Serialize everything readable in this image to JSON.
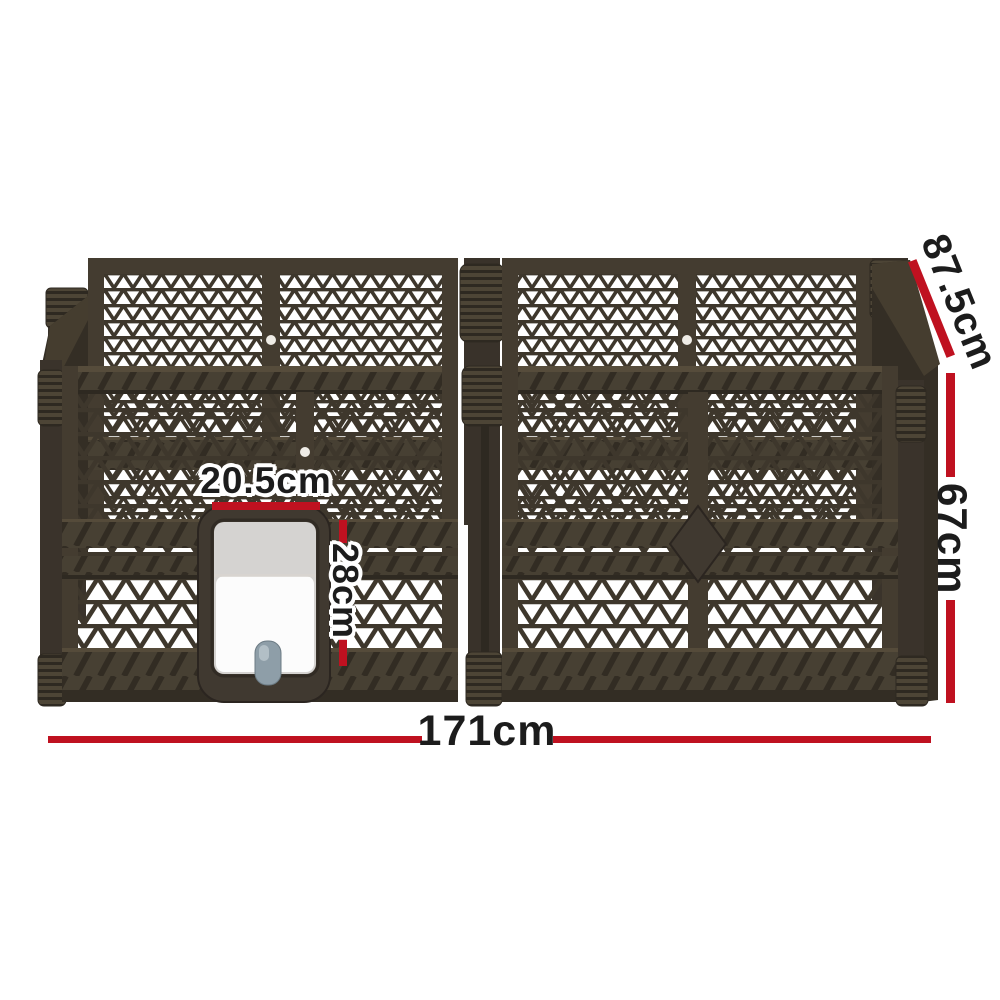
{
  "diagram": {
    "type": "product-dimensions",
    "subject": "foldable pet playpen with lockable pet door",
    "annotation_color": "#bf1120",
    "text_color": "#1c1c1c",
    "frame_color": "#443c30",
    "latch_color": "#8e9ea8"
  },
  "dimensions": {
    "length": "171cm",
    "height": "67cm",
    "depth": "87.5cm",
    "door_width": "20.5cm",
    "door_height": "28cm"
  }
}
